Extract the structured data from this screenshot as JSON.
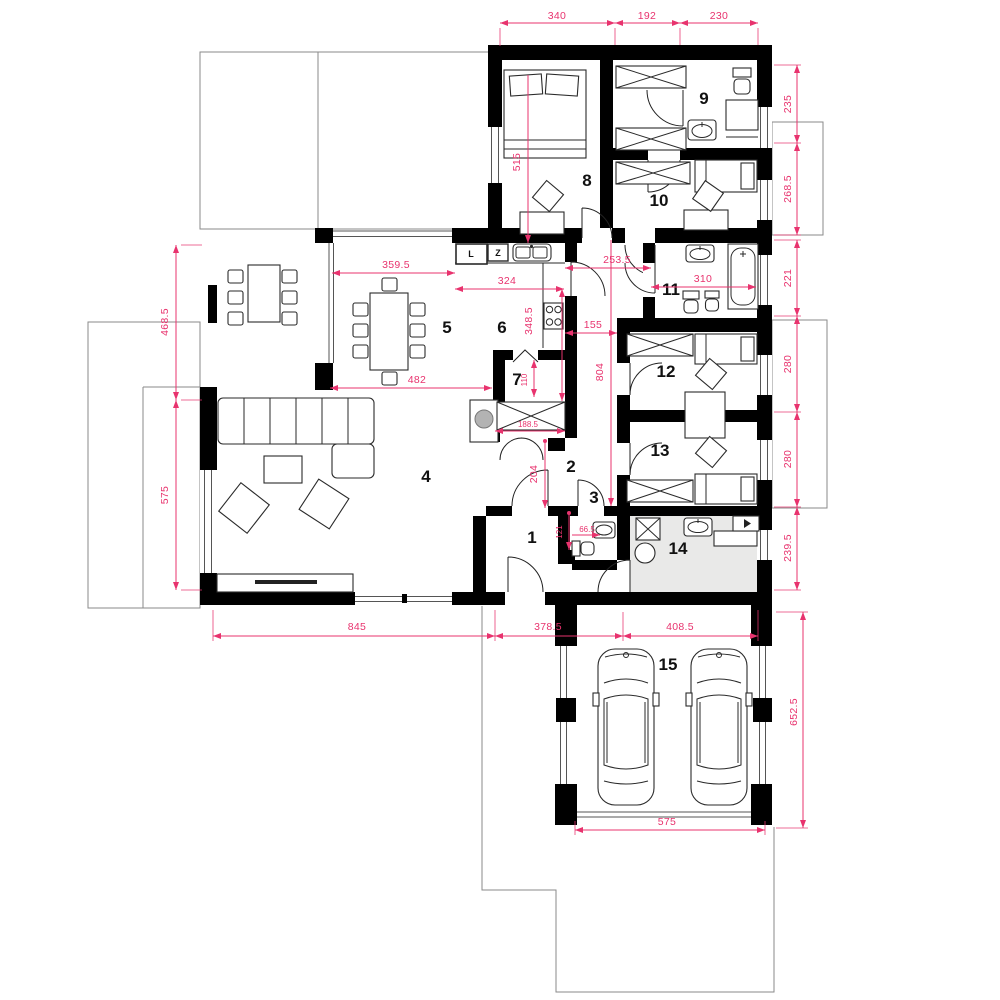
{
  "plan": {
    "type": "single-storey house floor plan with double garage",
    "colors": {
      "dimension": "#e8336e",
      "wall": "#000000",
      "site_outline": "#8a8a8a",
      "utility_floor": "#e9e9e8"
    }
  },
  "rooms": {
    "r1": "1",
    "r2": "2",
    "r3": "3",
    "r4": "4",
    "r5": "5",
    "r6": "6",
    "r7": "7",
    "r8": "8",
    "r9": "9",
    "r10": "10",
    "r11": "11",
    "r12": "12",
    "r13": "13",
    "r14": "14",
    "r15": "15"
  },
  "kitchen_markers": {
    "fridge": "L",
    "freezer": "Z"
  },
  "dimensions": {
    "top_340": "340",
    "top_192": "192",
    "top_230": "230",
    "right_235": "235",
    "right_268_5": "268.5",
    "right_221": "221",
    "right_280_a": "280",
    "right_280_b": "280",
    "right_239_5": "239.5",
    "right_652_5": "652.5",
    "left_468_5": "468.5",
    "left_575": "575",
    "bottom_845": "845",
    "bottom_378_5": "378.5",
    "bottom_408_5": "408.5",
    "garage_575": "575",
    "int_515": "515",
    "int_359_5": "359.5",
    "int_324": "324",
    "int_348_5": "348.5",
    "int_253_5": "253.5",
    "int_310": "310",
    "int_155": "155",
    "int_804": "804",
    "int_482": "482",
    "int_110": "110",
    "int_188_5": "188.5",
    "int_204": "204",
    "int_121": "121",
    "int_66_5": "66.5"
  }
}
